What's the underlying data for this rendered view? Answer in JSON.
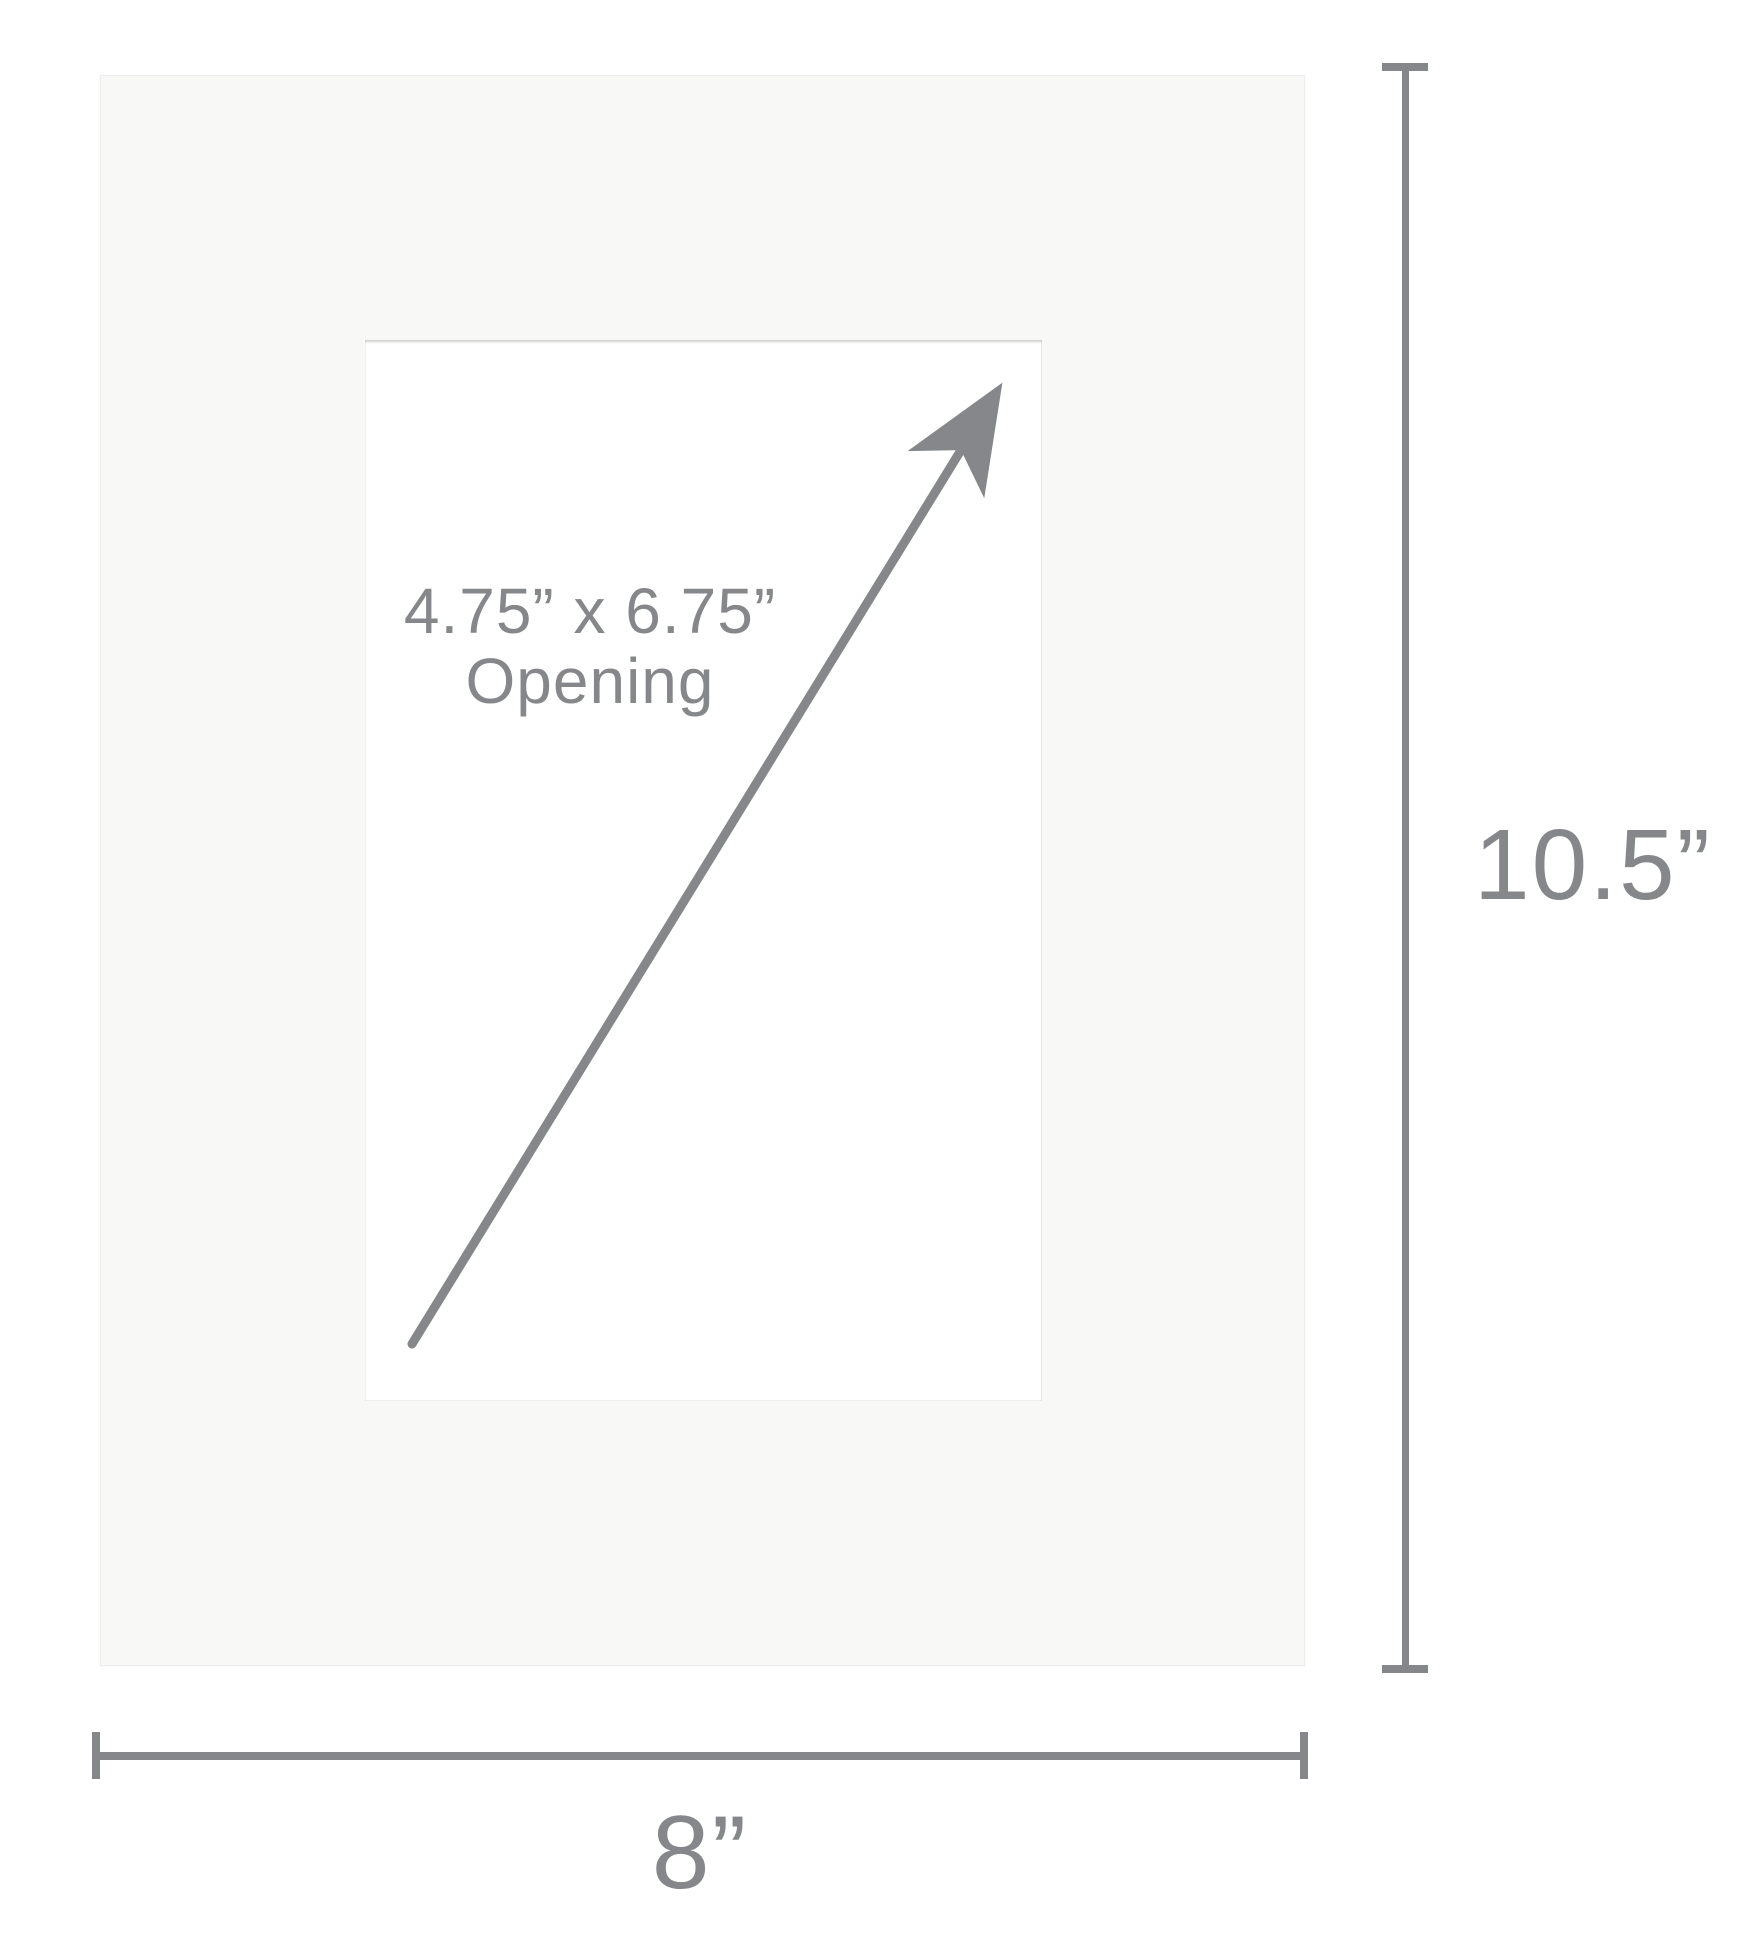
{
  "diagram": {
    "opening": {
      "size_line": "4.75” x 6.75”",
      "word_line": "Opening"
    },
    "dimensions": {
      "height": "10.5”",
      "width": "8”"
    }
  },
  "icons": {
    "arrow": "diagonal-arrow"
  },
  "colors": {
    "background": "#ffffff",
    "mat_board": "#f8f8f7",
    "opening": "#ffffff",
    "gray": "#85878a"
  }
}
